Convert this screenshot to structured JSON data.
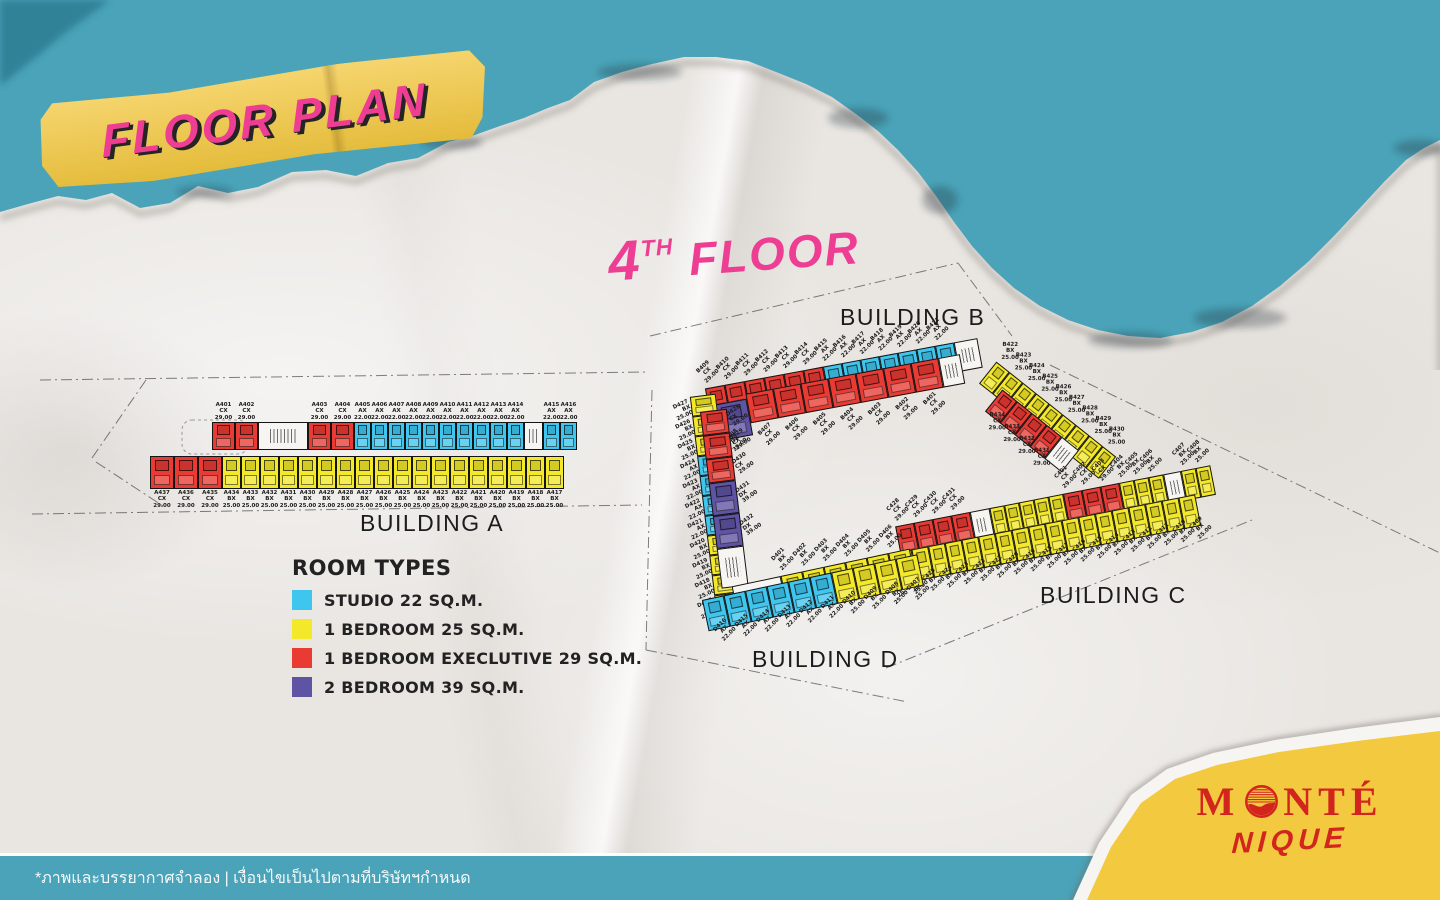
{
  "colors": {
    "teal": "#4AA3B8",
    "teal_dark": "#2B7A90",
    "paper": "#E9E6E2",
    "banner_yellow": "#F2C73E",
    "pink": "#EE3E93",
    "logo_red": "#D1251E",
    "corner_yellow": "#F3C93F",
    "footer_text": "#FFFFFF"
  },
  "title_banner": {
    "text": "FLOOR PLAN"
  },
  "floor_heading": {
    "number": "4",
    "suffix": "TH",
    "word": "FLOOR"
  },
  "room_types": {
    "AX": {
      "code": "AX",
      "name": "STUDIO 22 SQ.M.",
      "area": "22.00",
      "color": "#3EC6EF"
    },
    "BX": {
      "code": "BX",
      "name": "1 BEDROOM 25 SQ.M.",
      "area": "25.00",
      "color": "#F3E82A"
    },
    "CX": {
      "code": "CX",
      "name": "1 BEDROOM EXECLUTIVE 29 SQ.M.",
      "area": "29.00",
      "color": "#E93B34"
    },
    "DX": {
      "code": "DX",
      "name": "2 BEDROOM 39 SQ.M.",
      "area": "39.00",
      "color": "#5F53A3"
    }
  },
  "legend": {
    "title": "ROOM TYPES",
    "order": [
      "AX",
      "BX",
      "CX",
      "DX"
    ]
  },
  "buildings": {
    "a": {
      "label": "BUILDING A",
      "top_row": [
        {
          "no": "A401",
          "t": "CX"
        },
        {
          "no": "A402",
          "t": "CX"
        },
        {
          "core": 50
        },
        {
          "no": "A403",
          "t": "CX"
        },
        {
          "no": "A404",
          "t": "CX"
        },
        {
          "no": "A405",
          "t": "AX"
        },
        {
          "no": "A406",
          "t": "AX"
        },
        {
          "no": "A407",
          "t": "AX"
        },
        {
          "no": "A408",
          "t": "AX"
        },
        {
          "no": "A409",
          "t": "AX"
        },
        {
          "no": "A410",
          "t": "AX"
        },
        {
          "no": "A411",
          "t": "AX"
        },
        {
          "no": "A412",
          "t": "AX"
        },
        {
          "no": "A413",
          "t": "AX"
        },
        {
          "no": "A414",
          "t": "AX"
        },
        {
          "core": 19
        },
        {
          "no": "A415",
          "t": "AX"
        },
        {
          "no": "A416",
          "t": "AX"
        }
      ],
      "bottom_row": [
        {
          "no": "A437",
          "t": "CX"
        },
        {
          "no": "A436",
          "t": "CX"
        },
        {
          "no": "A435",
          "t": "CX"
        },
        {
          "no": "A434",
          "t": "BX"
        },
        {
          "no": "A433",
          "t": "BX"
        },
        {
          "no": "A432",
          "t": "BX"
        },
        {
          "no": "A431",
          "t": "BX"
        },
        {
          "no": "A430",
          "t": "BX"
        },
        {
          "no": "A429",
          "t": "BX"
        },
        {
          "no": "A428",
          "t": "BX"
        },
        {
          "no": "A427",
          "t": "BX"
        },
        {
          "no": "A426",
          "t": "BX"
        },
        {
          "no": "A425",
          "t": "BX"
        },
        {
          "no": "A424",
          "t": "BX"
        },
        {
          "no": "A423",
          "t": "BX"
        },
        {
          "no": "A422",
          "t": "BX"
        },
        {
          "no": "A421",
          "t": "BX"
        },
        {
          "no": "A420",
          "t": "BX"
        },
        {
          "no": "A419",
          "t": "BX"
        },
        {
          "no": "A418",
          "t": "BX"
        },
        {
          "no": "A417",
          "t": "BX"
        }
      ]
    },
    "b": {
      "label": "BUILDING B",
      "top_row": [
        {
          "no": "B409",
          "t": "CX"
        },
        {
          "no": "B410",
          "t": "CX"
        },
        {
          "no": "B411",
          "t": "CX"
        },
        {
          "no": "B412",
          "t": "CX"
        },
        {
          "no": "B413",
          "t": "CX"
        },
        {
          "no": "B414",
          "t": "CX"
        },
        {
          "no": "B415",
          "t": "AX"
        },
        {
          "no": "B416",
          "t": "AX"
        },
        {
          "no": "B417",
          "t": "AX"
        },
        {
          "no": "B418",
          "t": "AX"
        },
        {
          "no": "B419",
          "t": "AX"
        },
        {
          "no": "B420",
          "t": "AX"
        },
        {
          "no": "B421",
          "t": "AX"
        },
        {
          "core": 24
        }
      ],
      "bottom_row": [
        {
          "no": "B408",
          "t": "DX"
        },
        {
          "no": "B407",
          "t": "CX"
        },
        {
          "no": "B406",
          "t": "CX"
        },
        {
          "no": "B405",
          "t": "CX"
        },
        {
          "no": "B404",
          "t": "CX"
        },
        {
          "no": "B403",
          "t": "CX"
        },
        {
          "no": "B402",
          "t": "CX"
        },
        {
          "no": "B401",
          "t": "CX"
        },
        {
          "core": 22
        }
      ],
      "wing_outer": [
        {
          "no": "B422",
          "t": "BX"
        },
        {
          "no": "B423",
          "t": "BX"
        },
        {
          "no": "B424",
          "t": "BX"
        },
        {
          "no": "B425",
          "t": "BX"
        },
        {
          "no": "B426",
          "t": "BX"
        },
        {
          "no": "B427",
          "t": "BX"
        },
        {
          "no": "B428",
          "t": "BX"
        },
        {
          "no": "B429",
          "t": "BX"
        },
        {
          "no": "B430",
          "t": "BX"
        }
      ],
      "wing_inner": [
        {
          "no": "B434",
          "t": "CX"
        },
        {
          "no": "B433",
          "t": "CX"
        },
        {
          "no": "B432",
          "t": "CX"
        },
        {
          "no": "B431",
          "t": "CX"
        },
        {
          "core": 22
        }
      ]
    },
    "c": {
      "label": "BUILDING C",
      "top_row": [
        {
          "no": "C428",
          "t": "CX"
        },
        {
          "no": "C429",
          "t": "CX"
        },
        {
          "no": "C430",
          "t": "CX"
        },
        {
          "no": "C431",
          "t": "CX"
        },
        {
          "core": 20
        },
        {
          "t": "BX"
        },
        {
          "t": "BX"
        },
        {
          "t": "BX"
        },
        {
          "t": "BX"
        },
        {
          "t": "BX"
        },
        {
          "no": "C401",
          "t": "CX"
        },
        {
          "no": "C402",
          "t": "CX"
        },
        {
          "no": "C403",
          "t": "CX"
        },
        {
          "no": "C404",
          "t": "BX"
        },
        {
          "no": "C405",
          "t": "BX"
        },
        {
          "no": "C406",
          "t": "BX"
        },
        {
          "core": 18
        },
        {
          "no": "C407",
          "t": "BX"
        },
        {
          "no": "C408",
          "t": "BX"
        }
      ],
      "bottom_row": [
        {
          "no": "C427",
          "t": "BX"
        },
        {
          "no": "C426",
          "t": "BX"
        },
        {
          "no": "C425",
          "t": "BX"
        },
        {
          "no": "C424",
          "t": "BX"
        },
        {
          "no": "C423",
          "t": "BX"
        },
        {
          "no": "C422",
          "t": "BX"
        },
        {
          "no": "C421",
          "t": "BX"
        },
        {
          "no": "C420",
          "t": "BX"
        },
        {
          "no": "C419",
          "t": "BX"
        },
        {
          "no": "C418",
          "t": "BX"
        },
        {
          "no": "C417",
          "t": "BX"
        },
        {
          "no": "C416",
          "t": "BX"
        },
        {
          "no": "C415",
          "t": "BX"
        },
        {
          "no": "C414",
          "t": "BX"
        },
        {
          "no": "C413",
          "t": "BX"
        },
        {
          "no": "C412",
          "t": "BX"
        },
        {
          "no": "C411",
          "t": "BX"
        },
        {
          "no": "C410",
          "t": "BX"
        },
        {
          "no": "C409",
          "t": "BX"
        }
      ]
    },
    "d": {
      "label": "BUILDING D",
      "wing_outer": [
        {
          "no": "D427",
          "t": "BX"
        },
        {
          "no": "D426",
          "t": "BX"
        },
        {
          "no": "D425",
          "t": "BX"
        },
        {
          "no": "D424",
          "t": "AX"
        },
        {
          "no": "D423",
          "t": "AX"
        },
        {
          "no": "D422",
          "t": "AX"
        },
        {
          "no": "D421",
          "t": "AX"
        },
        {
          "no": "D420",
          "t": "BX"
        },
        {
          "no": "D419",
          "t": "BX"
        },
        {
          "no": "D418",
          "t": "BX"
        },
        {
          "no": "D417",
          "t": "BX"
        }
      ],
      "wing_inner": [
        {
          "no": "D428",
          "t": "CX"
        },
        {
          "no": "D429",
          "t": "CX"
        },
        {
          "no": "D430",
          "t": "CX"
        },
        {
          "no": "D431",
          "t": "DX"
        },
        {
          "no": "D432",
          "t": "DX"
        },
        {
          "core": 40
        }
      ],
      "low_top": [
        {
          "core": 50
        },
        {
          "no": "D401",
          "t": "BX"
        },
        {
          "no": "D402",
          "t": "BX"
        },
        {
          "no": "D403",
          "t": "BX"
        },
        {
          "no": "D404",
          "t": "BX"
        },
        {
          "no": "D405",
          "t": "BX"
        },
        {
          "no": "D406",
          "t": "BX"
        }
      ],
      "low_bottom": [
        {
          "no": "D416",
          "t": "AX"
        },
        {
          "no": "D415",
          "t": "AX"
        },
        {
          "no": "D414",
          "t": "AX"
        },
        {
          "no": "D413",
          "t": "AX"
        },
        {
          "no": "D412",
          "t": "AX"
        },
        {
          "no": "D411",
          "t": "AX"
        },
        {
          "no": "D410",
          "t": "BX"
        },
        {
          "no": "D409",
          "t": "BX"
        },
        {
          "no": "D408",
          "t": "BX"
        },
        {
          "no": "D407",
          "t": "BX"
        }
      ]
    }
  },
  "footer": {
    "disclaimer": "*ภาพและบรรยากาศจำลอง | เงื่อนไขเป็นไปตามที่บริษัทฯกำหนด"
  },
  "logo": {
    "line1_pre": "M",
    "line1_post": "NTÉ",
    "line1": "MONTÉ",
    "line2": "NIQUE"
  }
}
